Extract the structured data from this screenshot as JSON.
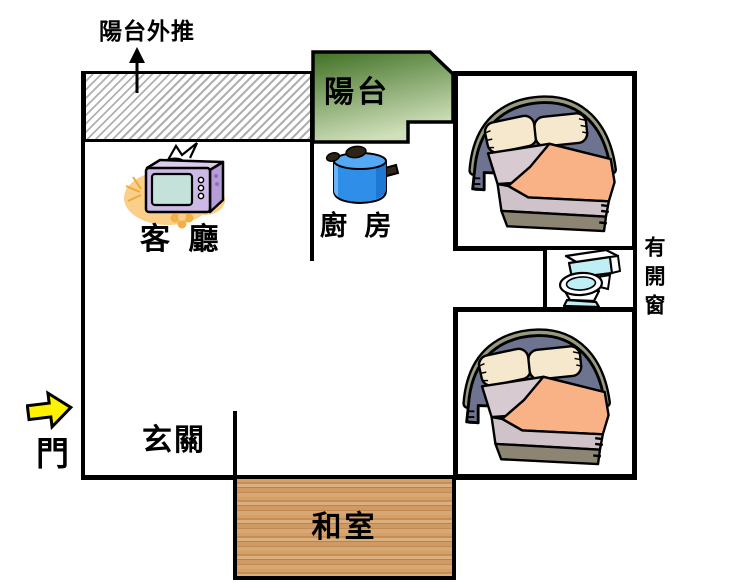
{
  "floorplan": {
    "annotation_top": "陽台外推",
    "balcony_label": "陽台",
    "living_room_label": "客 廳",
    "kitchen_label": "廚 房",
    "entry_label": "玄關",
    "door_label": "門",
    "tatami_label": "和室",
    "window_note": "有開窗"
  },
  "colors": {
    "wall_black": "#000000",
    "balcony_green_dark": "#3f7024",
    "balcony_green_light": "#cfe0ba",
    "wood_brown": "#cf9a63",
    "arrow_yellow": "#fff200",
    "hatch_gray": "#b0b0b0",
    "pot_blue": "#2f8fe8",
    "tv_purple": "#cdb9e6",
    "blanket_orange": "#f8b285",
    "toilet_cyan": "#bfeef4"
  },
  "icons": {
    "tv": "television",
    "pot": "cooking-pot",
    "bed": "double-bed",
    "toilet": "toilet",
    "door_arrow": "entry-direction-arrow",
    "pushout_arrow": "push-out-arrow"
  }
}
